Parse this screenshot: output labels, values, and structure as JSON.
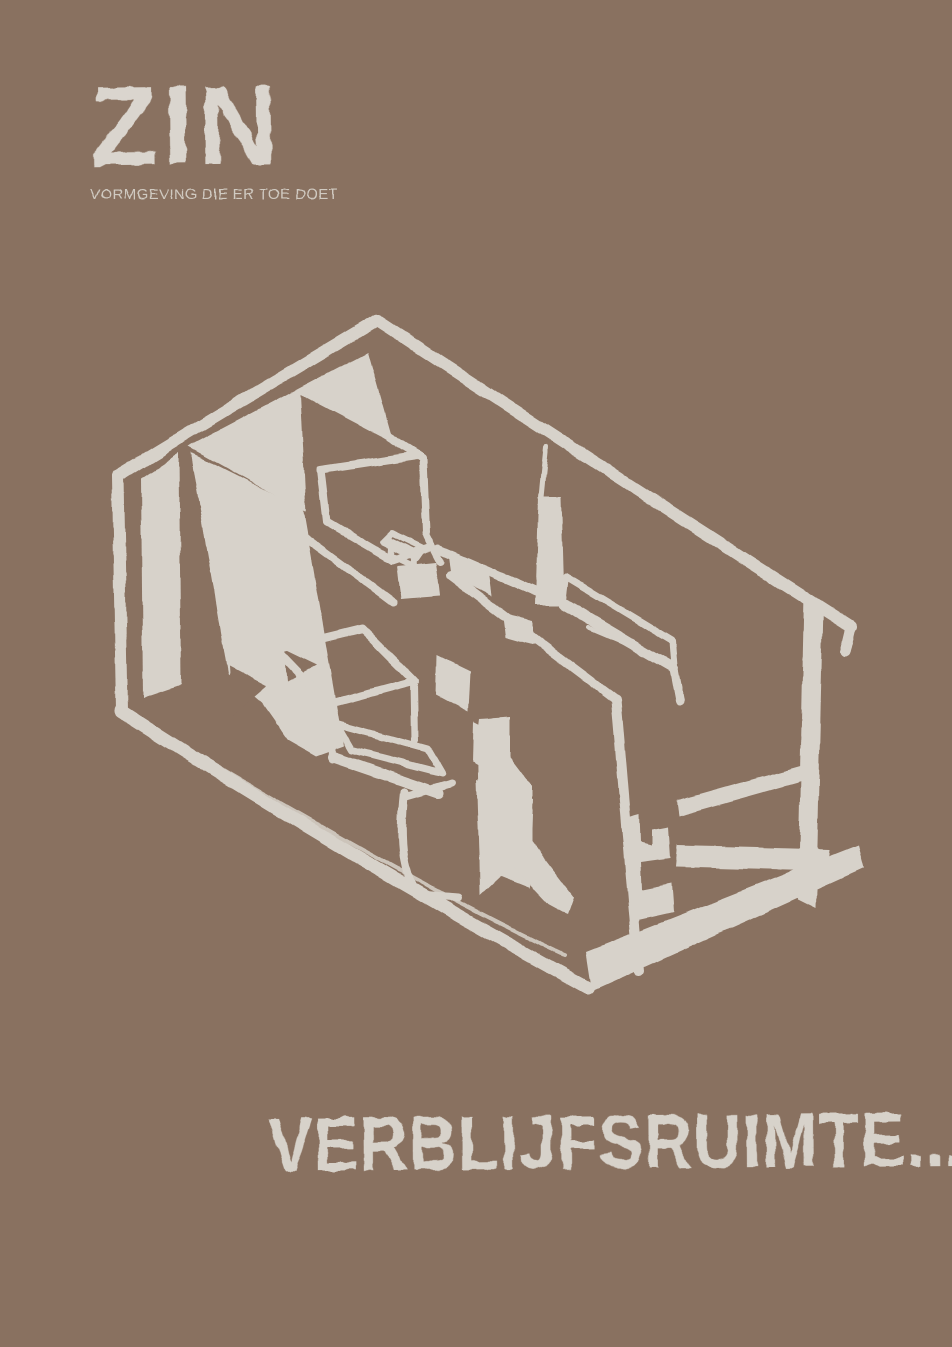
{
  "page": {
    "background_color": "#897160",
    "ink_color": "#d7d2ca"
  },
  "logo": {
    "title": "ZIN",
    "tagline": "VORMGEVING DIE ER TOE DOET",
    "color": "#dad5ce"
  },
  "illustration": {
    "name": "isometric-room-sketch",
    "description_label": "",
    "stroke_color": "#d7d2ca"
  },
  "headline": {
    "text": "VERBLIJFSRUIMTE...",
    "color": "#d7d2ca"
  }
}
